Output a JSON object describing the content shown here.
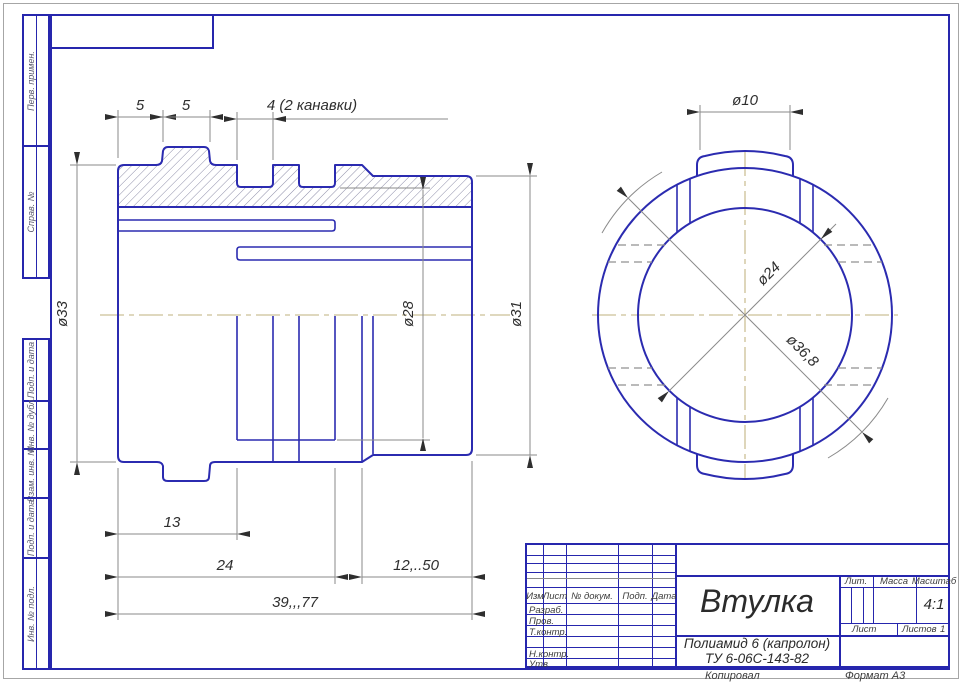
{
  "sidebar": {
    "top_boxes": [
      {
        "label": "Перв. примен."
      },
      {
        "label": "Справ. №"
      }
    ],
    "bottom_boxes": [
      {
        "label": "Подп. и дата"
      },
      {
        "label": "Инв. № дубл."
      },
      {
        "label": "Взам. инв. №"
      },
      {
        "label": "Подп. и дата"
      },
      {
        "label": "Инв. № подл."
      }
    ]
  },
  "title_block": {
    "header_cols": [
      "Изм",
      "Лист",
      "№ докум.",
      "Подп.",
      "Дата"
    ],
    "role_rows": [
      "Разраб.",
      "Пров.",
      "Т.контр.",
      "Н.контр.",
      "Утв."
    ],
    "part_name": "Втулка",
    "material_line1": "Полиамид 6 (капролон)",
    "material_line2": "ТУ 6-06С-143-82",
    "lit_label": "Лит.",
    "mass_label": "Масса",
    "scale_label": "Масштаб",
    "scale_value": "4:1",
    "sheet_label": "Лист",
    "sheets_label": "Листов",
    "sheets_value": "1",
    "copied_label": "Копировал",
    "format_label": "Формат  А3"
  },
  "dimensions": {
    "d5a": "5",
    "d5b": "5",
    "grooves": "4 (2 канавки)",
    "d33": "ø33",
    "d28": "ø28",
    "d31": "ø31",
    "d13": "13",
    "d24": "24",
    "d1250": "12,..50",
    "d3977": "39,,,77",
    "d10": "ø10",
    "d24c": "ø24",
    "d368": "ø36,8"
  },
  "colors": {
    "line_blue": "#2b2bb0",
    "frame_blue": "#2626ad",
    "center_tan": "#ccc096",
    "dim_gray": "#8a8a8a",
    "hatch": "#8d8da8"
  }
}
